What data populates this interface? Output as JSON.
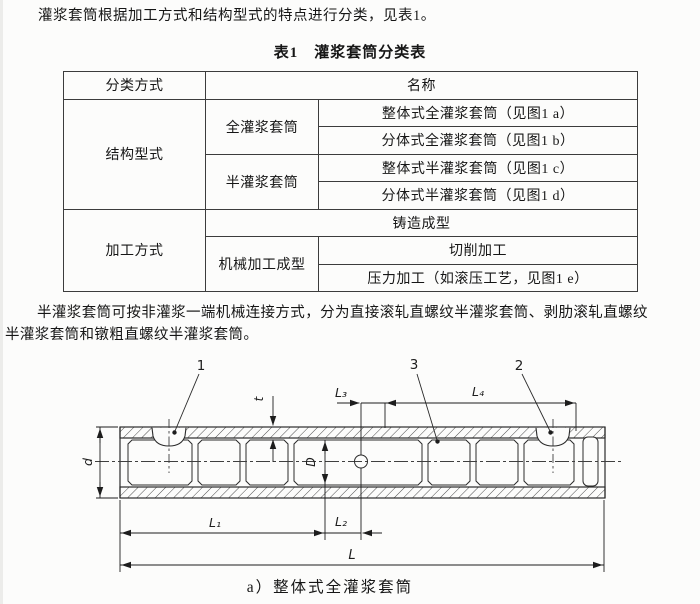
{
  "page": {
    "intro": "灌浆套筒根据加工方式和结构型式的特点进行分类，见表1。",
    "table_title": "表1　灌浆套筒分类表",
    "note_line1": "半灌浆套筒可按非灌浆一端机械连接方式，分为直接滚轧直螺纹半灌浆套筒、剥肋滚轧直螺纹",
    "note_line2": "半灌浆套筒和镦粗直螺纹半灌浆套筒。"
  },
  "table": {
    "headers": {
      "classification": "分类方式",
      "name": "名称"
    },
    "structure_type": {
      "label": "结构型式",
      "full": {
        "label": "全灌浆套筒",
        "integral": "整体式全灌浆套筒（见图1 a）",
        "split": "分体式全灌浆套筒（见图1 b）"
      },
      "half": {
        "label": "半灌浆套筒",
        "integral": "整体式半灌浆套筒（见图1 c）",
        "split": "分体式半灌浆套筒（见图1 d）"
      }
    },
    "processing": {
      "label": "加工方式",
      "casting": "铸造成型",
      "machining": {
        "label": "机械加工成型",
        "cutting": "切削加工",
        "pressure": "压力加工（如滚压工艺，见图1 e）"
      }
    }
  },
  "figure": {
    "caption": "a）整体式全灌浆套筒",
    "callouts": {
      "c1": "1",
      "c2": "2",
      "c3": "3"
    },
    "dims": {
      "d": "d",
      "t": "t",
      "D": "D",
      "L1": "L₁",
      "L2": "L₂",
      "L3": "L₃",
      "L4": "L₄",
      "L": "L"
    }
  }
}
